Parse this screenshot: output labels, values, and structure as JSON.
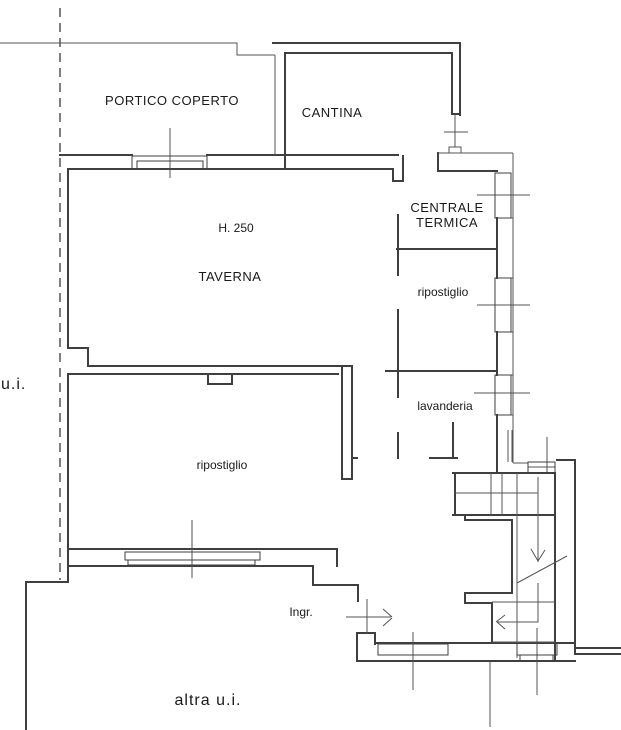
{
  "plan": {
    "title": "basement floor plan",
    "rooms": {
      "portico": "PORTICO COPERTO",
      "cantina": "CANTINA",
      "centrale_line1": "CENTRALE",
      "centrale_line2": "TERMICA",
      "taverna": "TAVERNA",
      "taverna_height": "H. 250",
      "ripostiglio_right": "ripostiglio",
      "lavanderia": "lavanderia",
      "ripostiglio_left": "ripostiglio",
      "ingresso": "Ingr."
    },
    "annotations": {
      "unit_left": "u.i.",
      "other_unit": "altra u.i."
    },
    "colors": {
      "background": "#ffffff",
      "wall_line": "#3f3f3f",
      "thin_line": "#555555",
      "text": "#1a1a1a"
    }
  }
}
